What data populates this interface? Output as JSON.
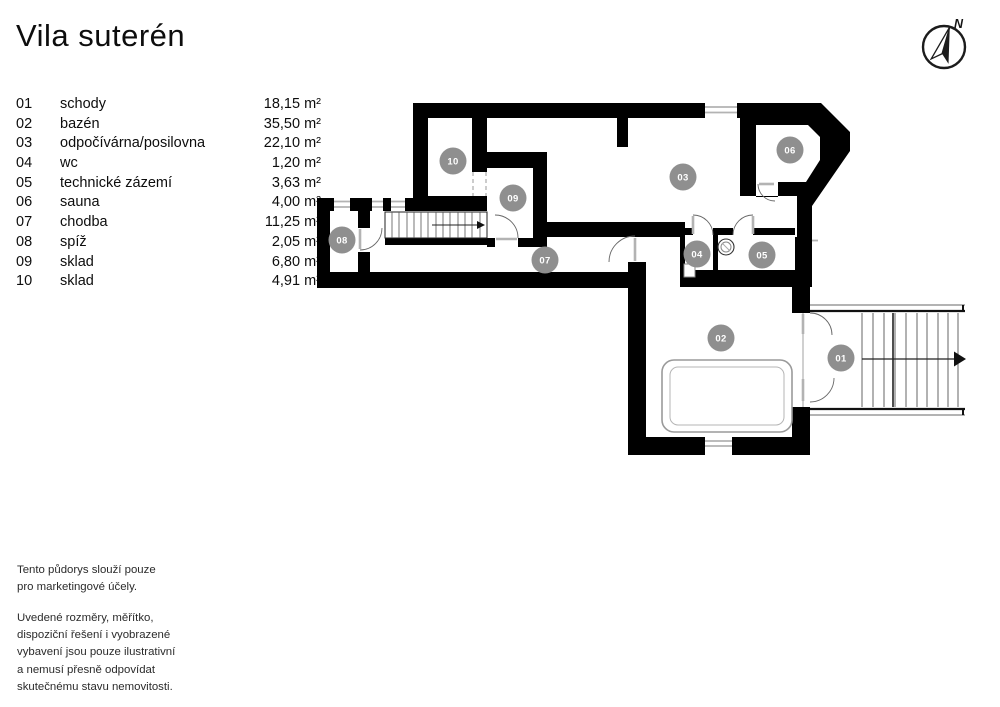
{
  "title": "Vila suterén",
  "legend": {
    "rooms": [
      {
        "num": "01",
        "name": "schody",
        "area": "18,15 m²"
      },
      {
        "num": "02",
        "name": "bazén",
        "area": "35,50 m²"
      },
      {
        "num": "03",
        "name": "odpočívárna/posilovna",
        "area": "22,10 m²"
      },
      {
        "num": "04",
        "name": "wc",
        "area": "1,20 m²"
      },
      {
        "num": "05",
        "name": "technické zázemí",
        "area": "3,63 m²"
      },
      {
        "num": "06",
        "name": "sauna",
        "area": "4,00 m²"
      },
      {
        "num": "07",
        "name": "chodba",
        "area": "11,25 m²"
      },
      {
        "num": "08",
        "name": "spíž",
        "area": "2,05 m²"
      },
      {
        "num": "09",
        "name": "sklad",
        "area": "6,80 m²"
      },
      {
        "num": "10",
        "name": "sklad",
        "area": "4,91 m²"
      }
    ]
  },
  "plan": {
    "badge_color": "#8f8f8f",
    "wall_color": "#000000",
    "badges": [
      {
        "label": "01",
        "x": 841,
        "y": 358
      },
      {
        "label": "02",
        "x": 721,
        "y": 338
      },
      {
        "label": "03",
        "x": 683,
        "y": 177
      },
      {
        "label": "04",
        "x": 697,
        "y": 254
      },
      {
        "label": "05",
        "x": 762,
        "y": 255
      },
      {
        "label": "06",
        "x": 790,
        "y": 150
      },
      {
        "label": "07",
        "x": 545,
        "y": 260
      },
      {
        "label": "08",
        "x": 342,
        "y": 240
      },
      {
        "label": "09",
        "x": 513,
        "y": 198
      },
      {
        "label": "10",
        "x": 453,
        "y": 161
      }
    ],
    "compass_label": "N"
  },
  "disclaimer": {
    "p1": "Tento půdorys slouží pouze\npro marketingové účely.",
    "p2": "Uvedené rozměry, měřítko,\ndispoziční řešení i vyobrazené\nvybavení jsou pouze ilustrativní\na nemusí přesně odpovídat\nskutečnému stavu nemovitosti."
  }
}
